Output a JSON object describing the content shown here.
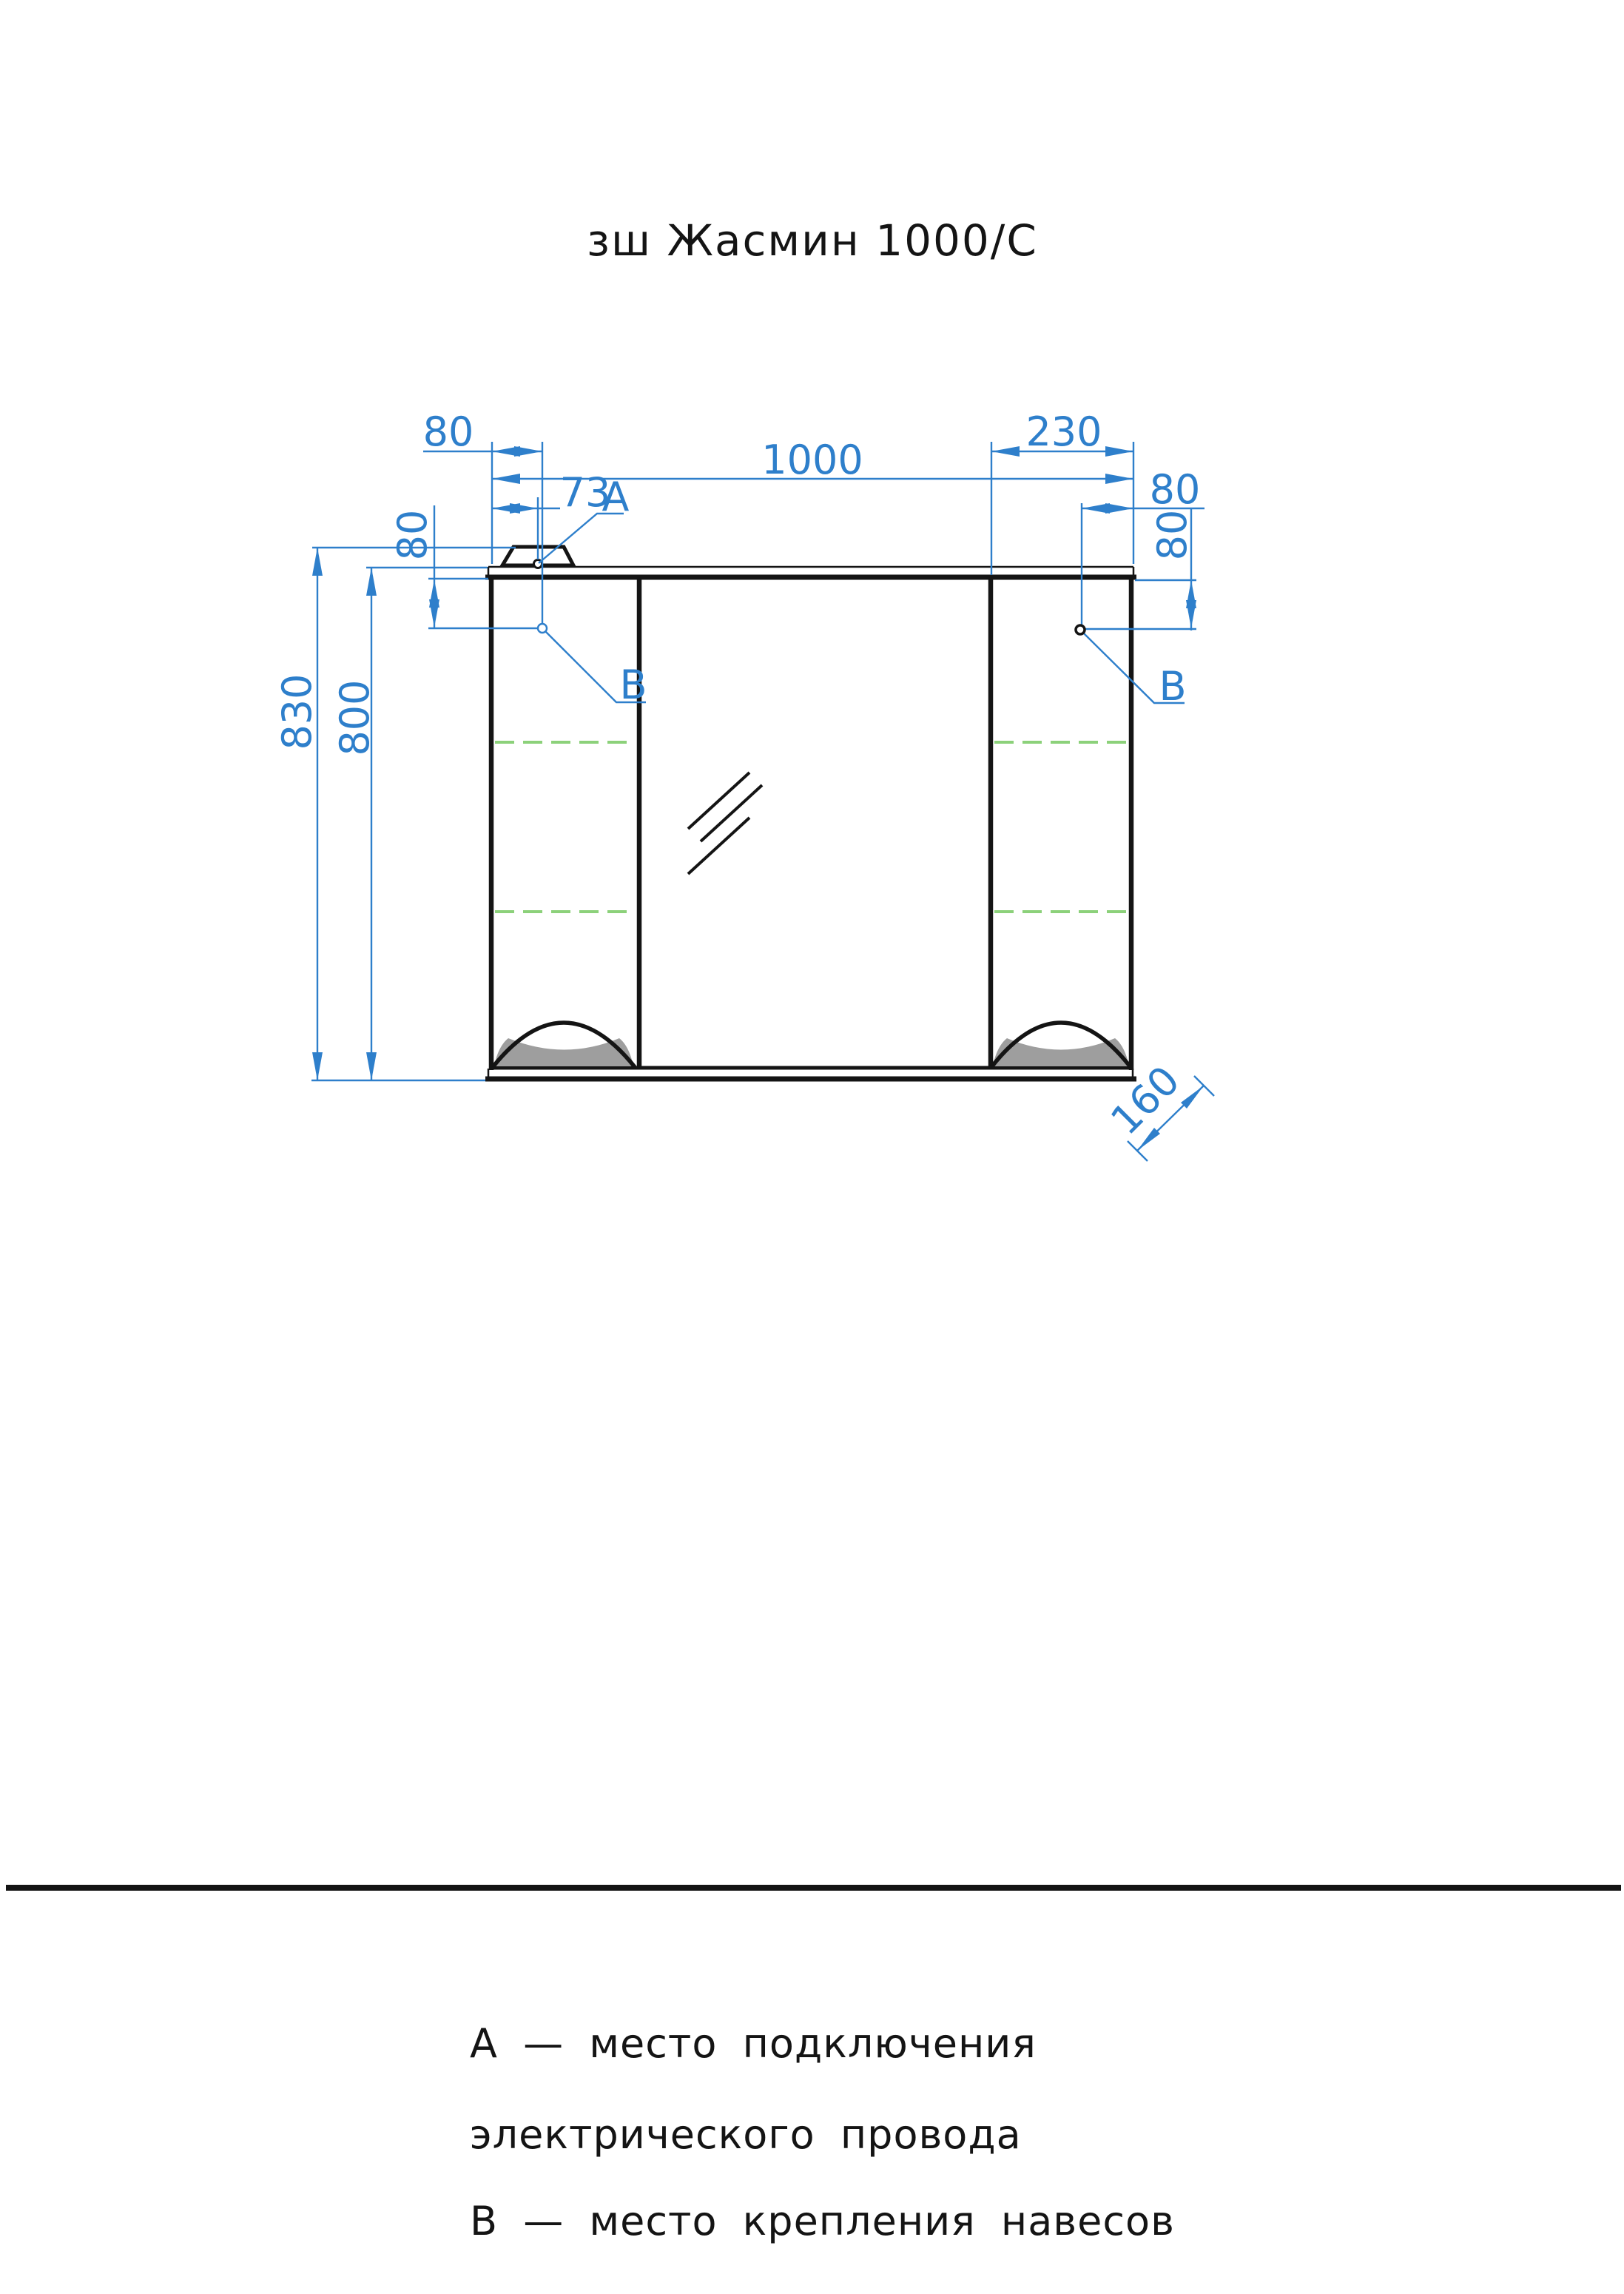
{
  "title": "зш Жасмин 1000/С",
  "product": {
    "type": "mirror-cabinet-front-view"
  },
  "colors": {
    "dimension_blue": "#2e7fcb",
    "shelf_dashed_green": "#8cd17a",
    "handle_fill_gray": "#9e9e9e",
    "outline_black": "#141414"
  },
  "dimensions": {
    "width": "1000",
    "total_height": "830",
    "body_height": "800",
    "depth": "160",
    "right_door_width": "230",
    "hanger_offset_left": "80",
    "power_point_offset": "73",
    "hanger_offset_right": "80",
    "hanger_drop_left": "80",
    "hanger_drop_right": "80"
  },
  "markers": {
    "power_point": "А",
    "hanger_left": "В",
    "hanger_right": "В"
  },
  "legend": {
    "line1": "А — место подключения",
    "line2": "электрического провода",
    "line3": "В — место крепления навесов"
  }
}
